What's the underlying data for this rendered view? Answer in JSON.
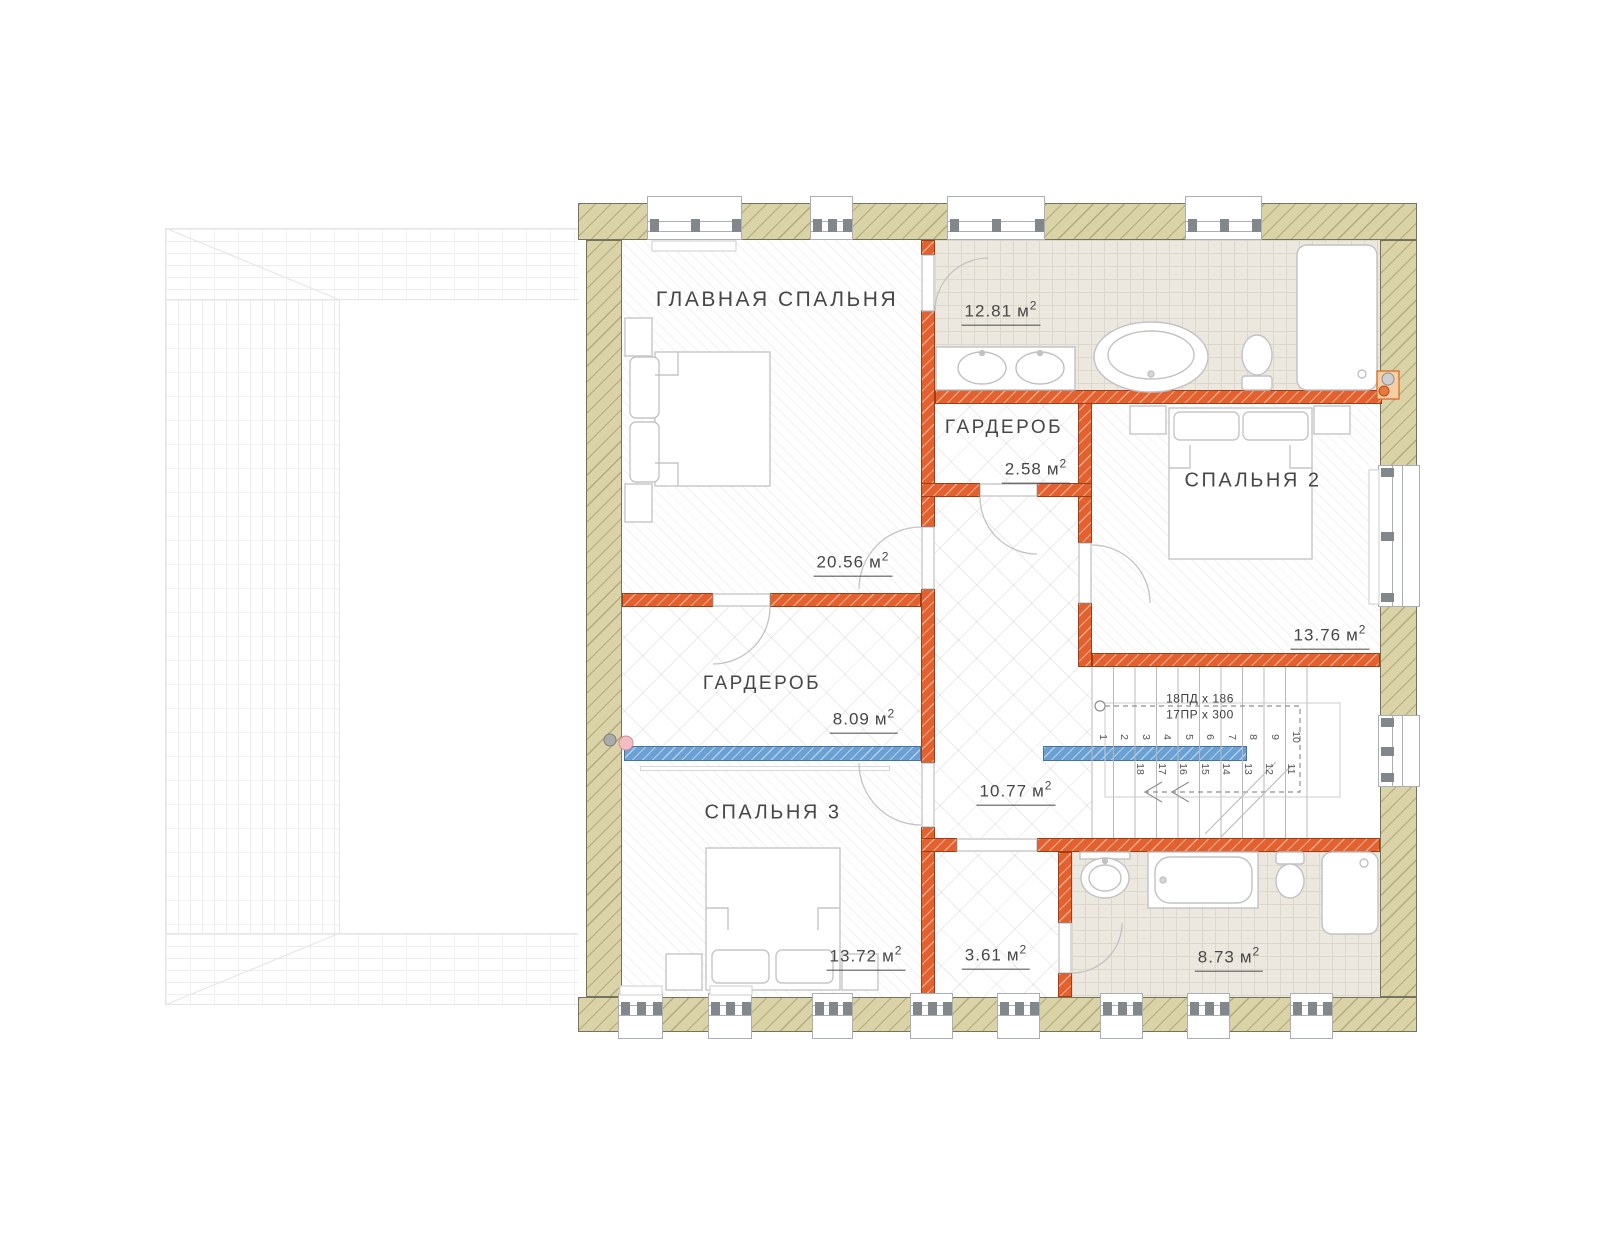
{
  "rooms": [
    {
      "id": "master-bedroom",
      "name": "ГЛАВНАЯ СПАЛЬНЯ",
      "area": "20.56"
    },
    {
      "id": "bathroom-top",
      "area": "12.81"
    },
    {
      "id": "wardrobe-top",
      "name": "ГАРДЕРОБ",
      "area": "2.58"
    },
    {
      "id": "bedroom-2",
      "name": "СПАЛЬНЯ 2",
      "area": "13.76"
    },
    {
      "id": "wardrobe-left",
      "name": "ГАРДЕРОБ",
      "area": "8.09"
    },
    {
      "id": "bedroom-3",
      "name": "СПАЛЬНЯ 3",
      "area": "13.72"
    },
    {
      "id": "hall",
      "area": "10.77"
    },
    {
      "id": "closet",
      "area": "3.61"
    },
    {
      "id": "bathroom-bottom",
      "area": "8.73"
    }
  ],
  "units": {
    "area_unit": "м",
    "area_sup": "2"
  },
  "stairs": {
    "note_line1": "18ПД x 186",
    "note_line2": "17ПР x 300",
    "up_numbers": [
      "1",
      "2",
      "3",
      "4",
      "5",
      "6",
      "7",
      "8",
      "9",
      "10"
    ],
    "return_numbers": [
      "18",
      "17",
      "16",
      "15",
      "14",
      "13",
      "12",
      "11"
    ]
  },
  "colors": {
    "exterior_wall": "#d9d3a7",
    "interior_wall": "#e2612e",
    "handrail_blue": "#6aa0d4",
    "bathroom_floor": "#ece8e0"
  }
}
